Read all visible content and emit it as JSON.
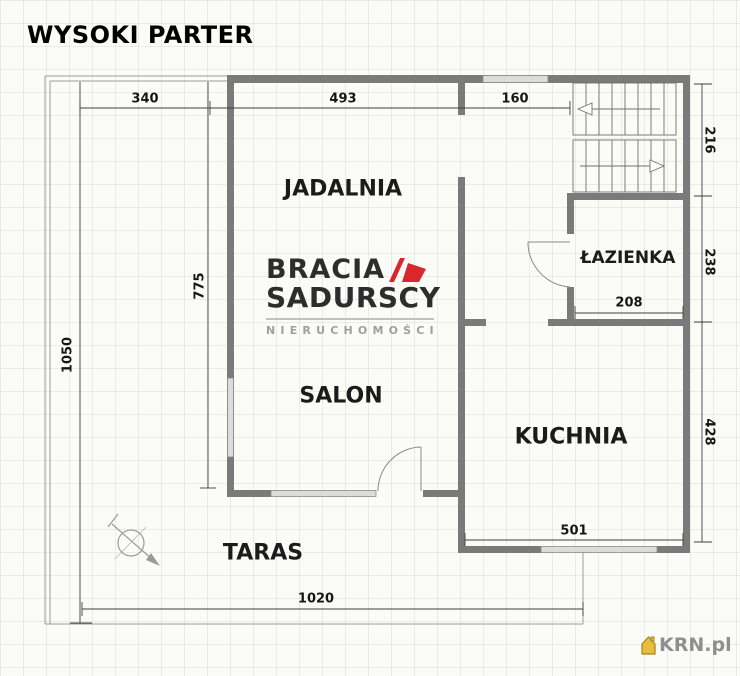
{
  "title": "WYSOKI PARTER",
  "rooms": {
    "jadalnia": "JADALNIA",
    "salon": "SALON",
    "kuchnia": "KUCHNIA",
    "lazienka": "ŁAZIENKA",
    "taras": "TARAS"
  },
  "dims": {
    "d340": "340",
    "d493": "493",
    "d160": "160",
    "d216": "216",
    "d238": "238",
    "d208": "208",
    "d428": "428",
    "d501": "501",
    "d1020": "1020",
    "d1050": "1050",
    "d775": "775"
  },
  "watermark": {
    "line1": "BRACIA",
    "line2": "SADURSCY",
    "line3": "NIERUCHOMOŚCI"
  },
  "footer_brand": "KRN.pl",
  "colors": {
    "wall": "#7a7a7a",
    "window_fill": "#dcdcdc",
    "thin_line": "#9b9b9b",
    "dim_line": "#3f3f3f",
    "logo_red": "#d9272e",
    "logo_dark": "#2d2d2d",
    "logo_gray": "#a39d9d",
    "krn_gray": "#8f8f8f",
    "house_gold": "#e6bd3f"
  }
}
